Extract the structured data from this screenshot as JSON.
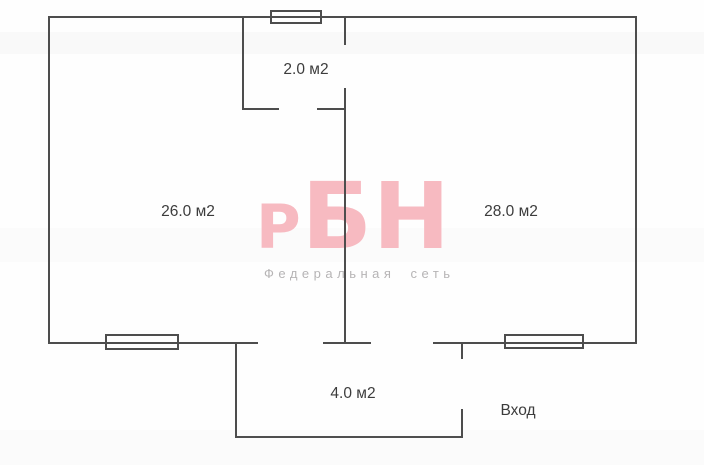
{
  "floorplan": {
    "type": "apartment-floor-plan",
    "rooms": [
      {
        "name": "closet",
        "area_label": "2.0 м2"
      },
      {
        "name": "room-left",
        "area_label": "26.0 м2"
      },
      {
        "name": "room-right",
        "area_label": "28.0 м2"
      },
      {
        "name": "vestibule",
        "area_label": "4.0 м2"
      }
    ],
    "entrance_label": "Вход",
    "window_count": 3
  },
  "watermark": {
    "logo_prefix": "Р",
    "logo_rest": "БН",
    "tagline": "Федеральная сеть",
    "logo_color": "#f7bac1",
    "tagline_color": "#b6b4b5"
  },
  "colors": {
    "wall": "#4d4d4d",
    "label_text": "#3c3c3c",
    "background": "#fefefe"
  }
}
